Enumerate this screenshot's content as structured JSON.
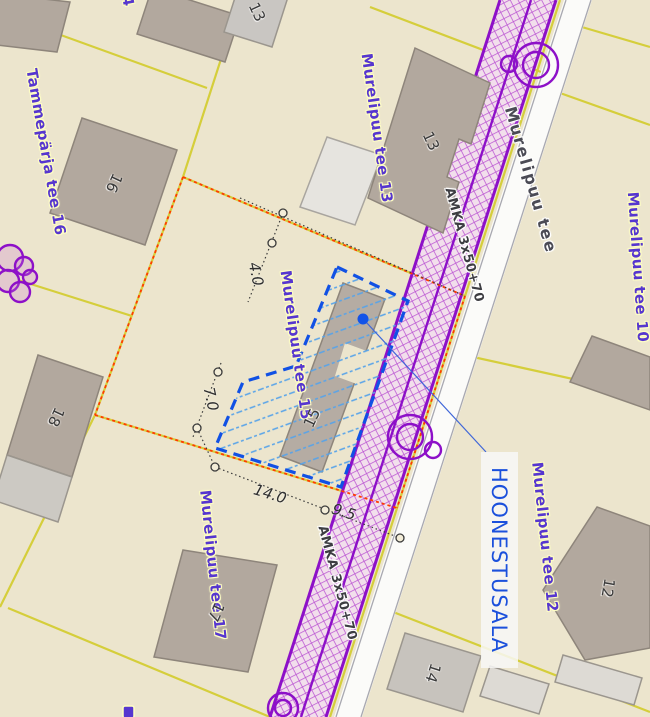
{
  "map": {
    "parcel_labels": {
      "tammeparja_tee_16": "Tammepärja tee 16",
      "murelipuu_tee_13": "Murelipuu tee 13",
      "murelipuu_tee_15": "Murelipuu tee 15",
      "murelipuu_tee_17": "Murelipuu tee 17",
      "murelipuu_tee_12": "Murelipuu tee 12",
      "murelipuu_tee_10": "Murelipuu tee 10"
    },
    "street_label": "Murelipuu tee",
    "utility_label": "AMKA 3x50+70",
    "annotation": {
      "hoonestusala": "HOONESTUSALA"
    },
    "building_numbers": {
      "b16": "16",
      "b13": "13",
      "b13_top": "13",
      "b18": "18",
      "b15": "15",
      "b17": "17",
      "b12": "12",
      "b14": "14"
    },
    "dimensions": {
      "dim_top": "4.0",
      "dim_left": "7.0",
      "dim_bottom": "14.0",
      "dim_road": "9.5"
    },
    "partial_labels": {
      "top_edge_digit": "4"
    },
    "colors": {
      "background": "#ece5cd",
      "parcel_line_yellow": "#d5ce3b",
      "boundary_orange_red": "#ff3c00",
      "building_area_blue": "#1151e4",
      "hatch_light_blue": "#57a3e9",
      "corridor_purple": "#8d10c8",
      "label_purple": "#5636cf",
      "annotation_blue": "#1b50dc",
      "building_fill": "#b2a89e",
      "road_white": "#fbfbf9"
    }
  }
}
